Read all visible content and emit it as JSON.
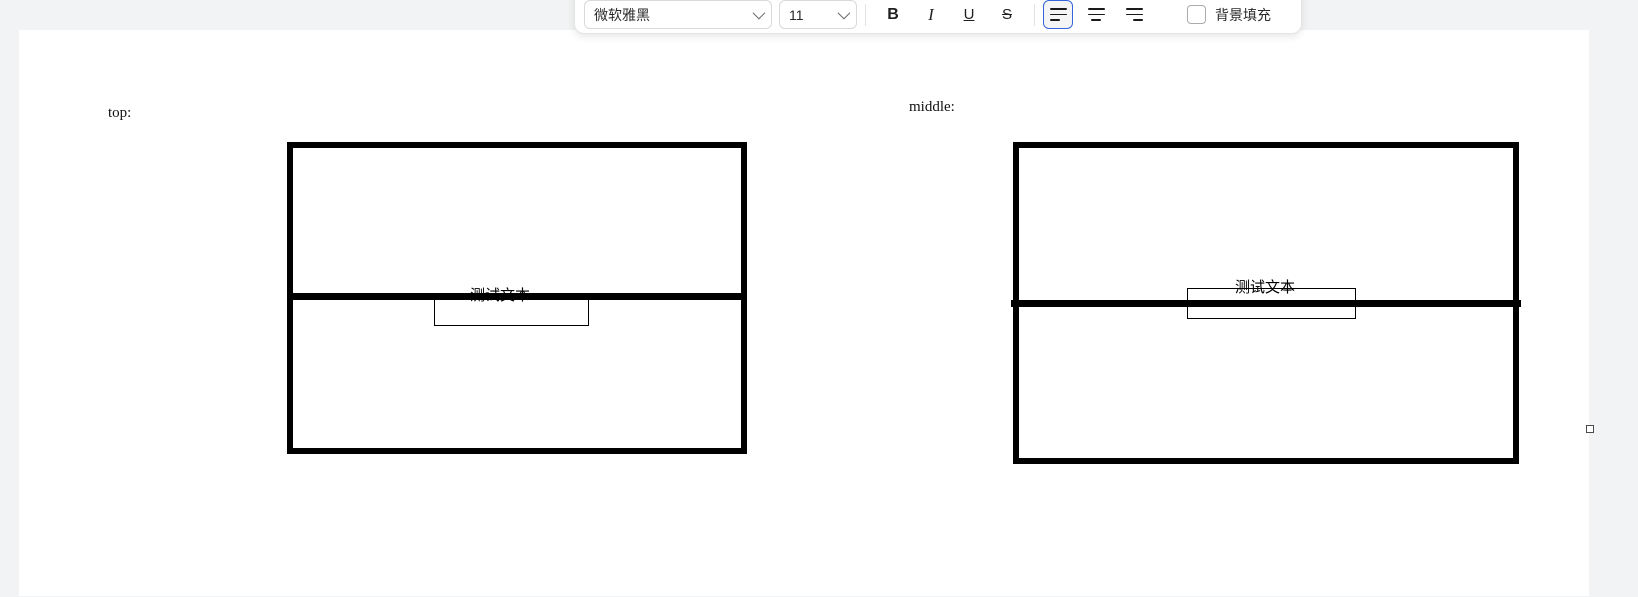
{
  "toolbar": {
    "font_name": "微软雅黑",
    "font_size": "11",
    "bold": "B",
    "italic": "I",
    "underline": "U",
    "strikethrough": "S",
    "background_fill_label": "背景填充",
    "accent_color": "#3565d9",
    "align_selected": "align-left"
  },
  "sections": {
    "left": {
      "label": "top:",
      "box_text": "测试文本"
    },
    "right": {
      "label": "middle:",
      "box_text": "测试文本"
    }
  }
}
